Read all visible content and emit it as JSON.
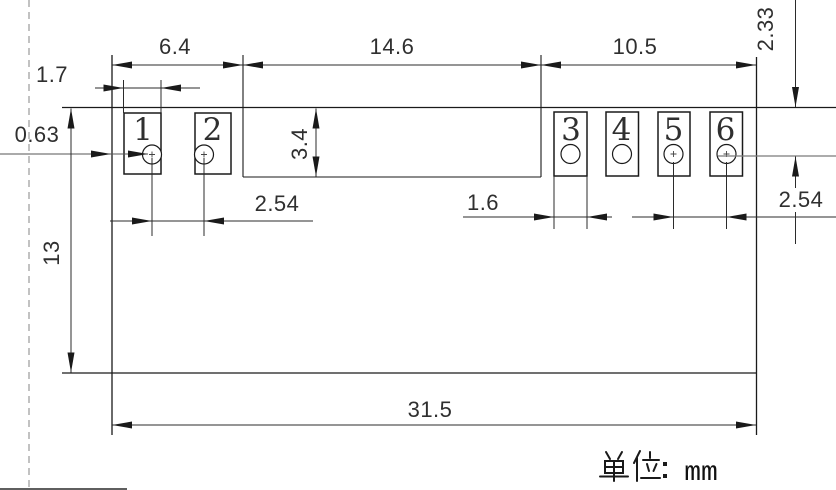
{
  "drawing": {
    "pin_numbers": [
      "1",
      "2",
      "3",
      "4",
      "5",
      "6"
    ],
    "dimensions": {
      "left_edge_to_step": "6.4",
      "step_width": "14.6",
      "right_group_width": "10.5",
      "pad1_width": "1.7",
      "left_edge_offset": "0.63",
      "step_height": "3.4",
      "body_height": "13",
      "pads_1_2_pitch": "2.54",
      "pad3_width": "1.6",
      "pads_5_6_pitch": "2.54",
      "top_edge_to_hole_row": "2.33",
      "body_width": "31.5"
    },
    "footer": {
      "unit_label": "单位：mm",
      "unit_value": "mm"
    },
    "colors": {
      "pin_number": "#f00000",
      "line_dark": "#1a1a1a",
      "line_gray": "#7a7a7a",
      "dashed_centerline": "#9a9a9a"
    }
  }
}
